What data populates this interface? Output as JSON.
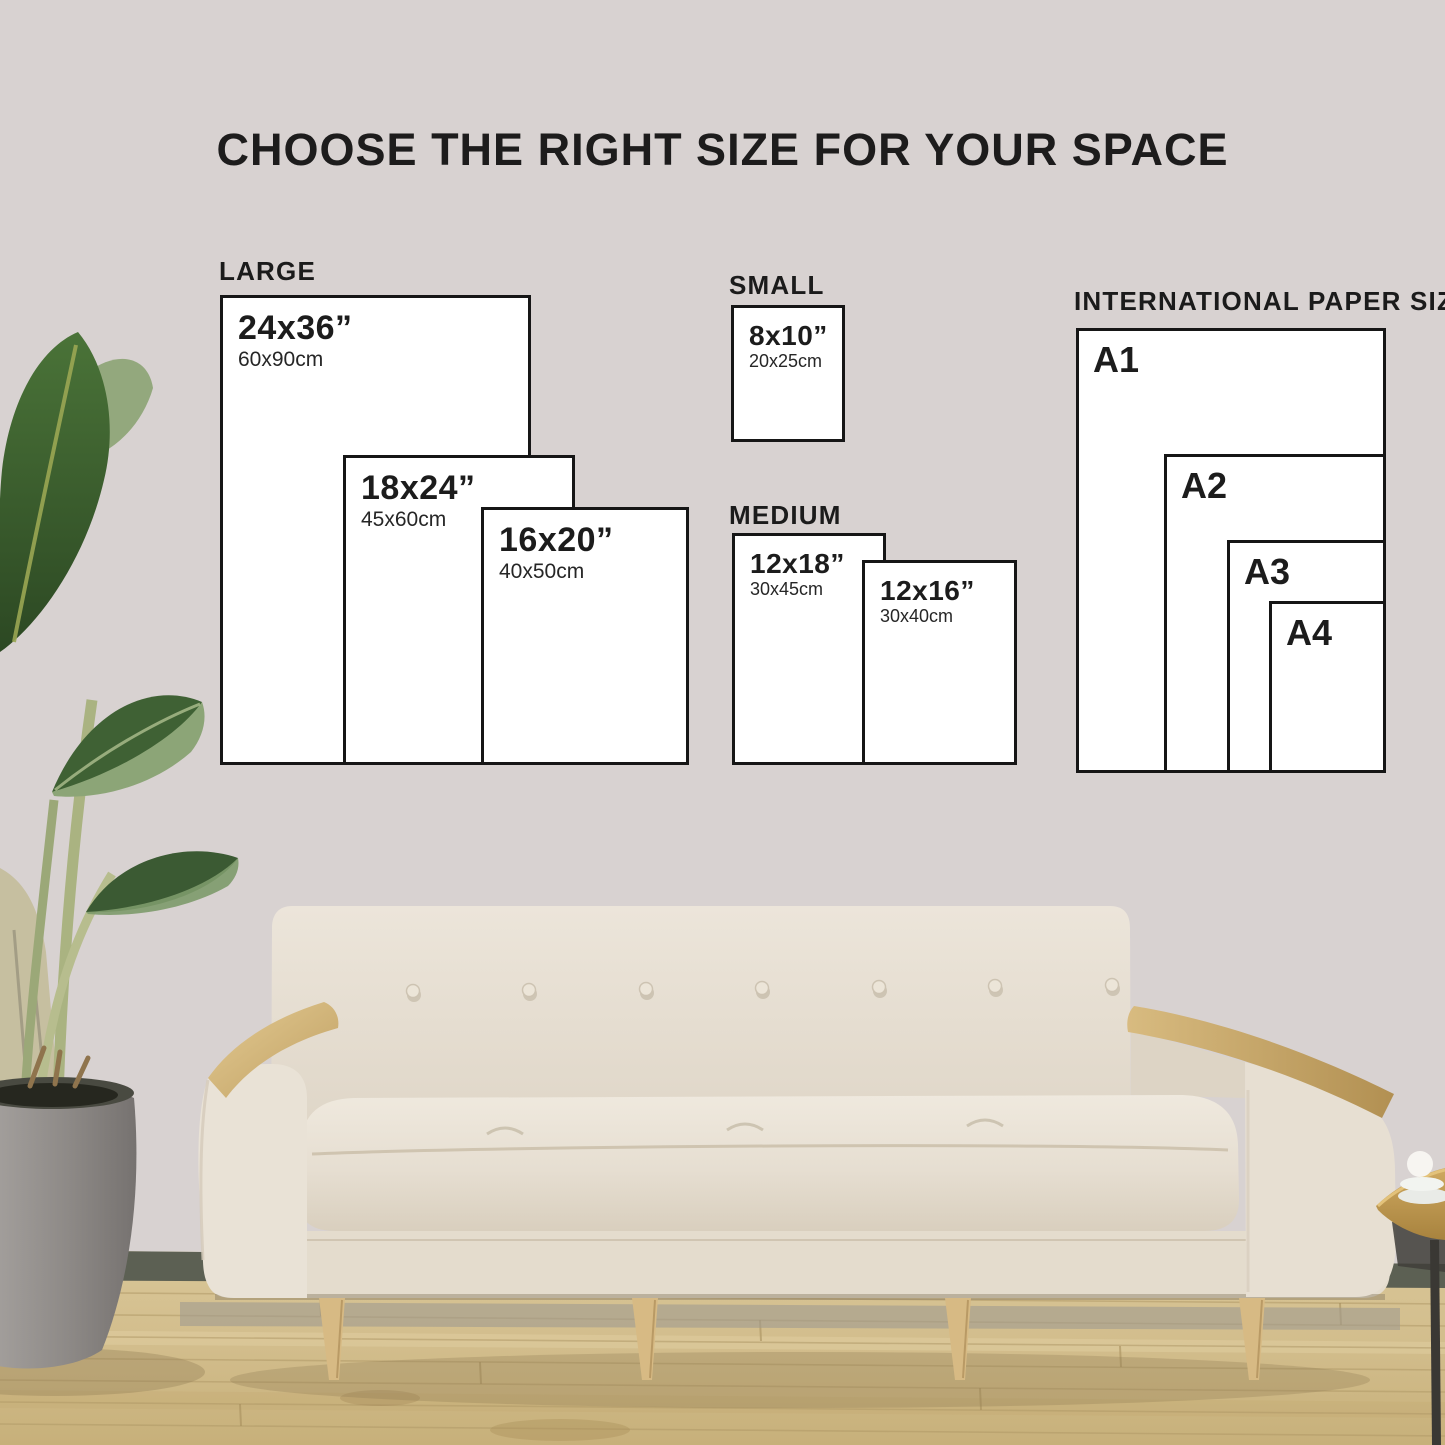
{
  "title": "CHOOSE THE RIGHT SIZE FOR YOUR SPACE",
  "groups": {
    "large": {
      "label": "LARGE",
      "sizes": [
        {
          "in": "24x36”",
          "cm": "60x90cm"
        },
        {
          "in": "18x24”",
          "cm": "45x60cm"
        },
        {
          "in": "16x20”",
          "cm": "40x50cm"
        }
      ]
    },
    "small": {
      "label": "SMALL",
      "sizes": [
        {
          "in": "8x10”",
          "cm": "20x25cm"
        }
      ]
    },
    "medium": {
      "label": "MEDIUM",
      "sizes": [
        {
          "in": "12x18”",
          "cm": "30x45cm"
        },
        {
          "in": "12x16”",
          "cm": "30x40cm"
        }
      ]
    },
    "international": {
      "label": "INTERNATIONAL PAPER SIZE",
      "sizes": [
        {
          "name": "A1"
        },
        {
          "name": "A2"
        },
        {
          "name": "A3"
        },
        {
          "name": "A4"
        }
      ]
    }
  },
  "colors": {
    "accent": "#161616",
    "paper": "#ffffff",
    "wall": "#eae4e3"
  }
}
